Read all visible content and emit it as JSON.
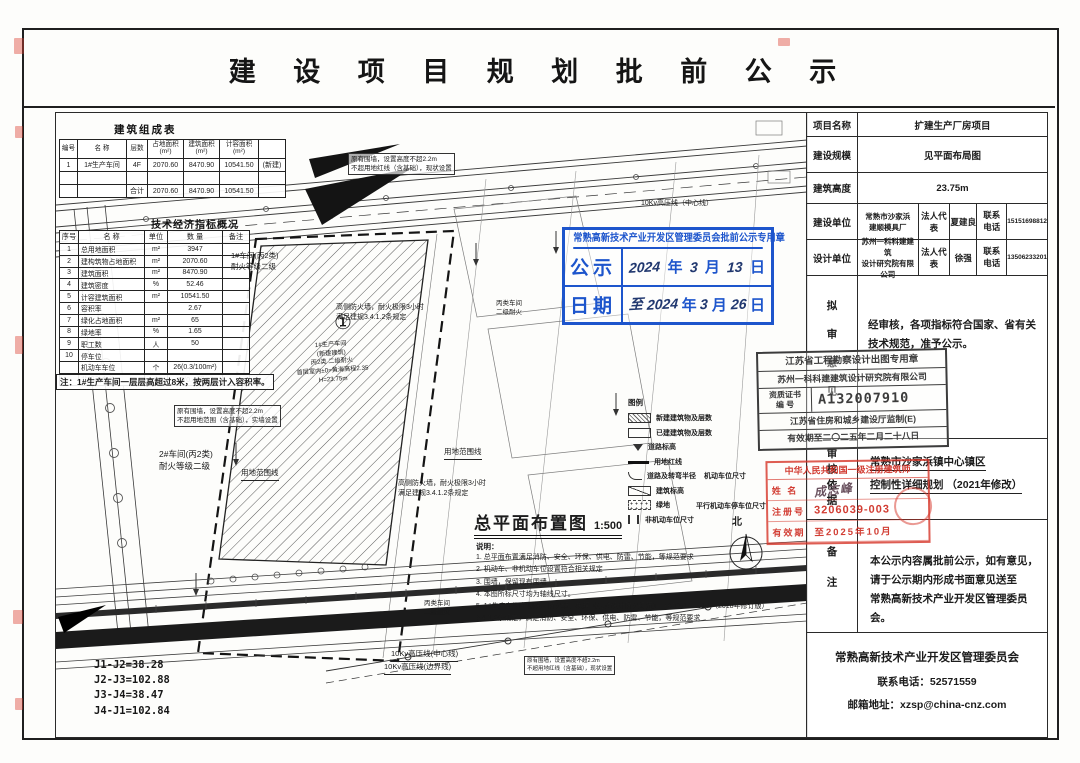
{
  "page": {
    "title": "建 设 项 目 规 划 批 前 公 示"
  },
  "comp_table": {
    "title": "建筑组成表",
    "h": [
      "编号",
      "名 称",
      "层数",
      "占地面积\n(m²)",
      "建筑面积\n(m²)",
      "计容面积\n(m²)",
      ""
    ],
    "rows": [
      [
        "1",
        "1#生产车间",
        "4F",
        "2070.60",
        "8470.90",
        "10541.50",
        "(新建)"
      ],
      [
        "",
        "",
        "",
        "",
        "",
        "",
        ""
      ],
      [
        "",
        "",
        "合计",
        "2070.60",
        "8470.90",
        "10541.50",
        ""
      ]
    ]
  },
  "ind_table": {
    "title": "技术经济指标概况",
    "h": [
      "序号",
      "名  称",
      "单位",
      "数 量",
      "备注"
    ],
    "rows": [
      [
        "1",
        "总用地面积",
        "m²",
        "3947",
        ""
      ],
      [
        "2",
        "建构筑物占地面积",
        "m²",
        "2070.60",
        ""
      ],
      [
        "3",
        "建筑面积",
        "m²",
        "8470.90",
        ""
      ],
      [
        "4",
        "建筑密度",
        "%",
        "52.46",
        ""
      ],
      [
        "5",
        "计容建筑面积",
        "m²",
        "10541.50",
        ""
      ],
      [
        "6",
        "容积率",
        "",
        "2.67",
        ""
      ],
      [
        "7",
        "绿化占地面积",
        "m²",
        "65",
        ""
      ],
      [
        "8",
        "绿地率",
        "%",
        "1.65",
        ""
      ],
      [
        "9",
        "职工数",
        "人",
        "50",
        ""
      ],
      [
        "10",
        "停车位",
        "",
        "",
        ""
      ],
      [
        "",
        "机动车车位",
        "个",
        "26(0.3/100m²)",
        ""
      ],
      [
        "",
        "非机动车位",
        "个",
        "20(0.4/职工)",
        ""
      ]
    ],
    "note": "注：1#生产车间一层层高超过8米，按两层计入容积率。"
  },
  "plan": {
    "title": "总平面布置图",
    "scale": "1:500",
    "notes_title": "说明：",
    "notes": [
      "1. 总平面布置满足消防、安全、环保、供电、防雷、节能，等规范要求",
      "2. 机动车、非机动车位设置符合相关规定",
      "3. 围墙，保留现有围墙",
      "4. 本图所标尺寸均为轴线尺寸。",
      "5. 1#生产车间东侧设置防火墙，按照《建筑设计防火规范》 GB50016-2014 （2018年修订版）",
      "3.4.1.2条规定，满足消防、安全、环保、供电、防雷、节能，等规范要求"
    ],
    "legend_title": "图例",
    "legend": [
      "新建建筑物及层数",
      "已建建筑物及层数",
      "道路标高",
      "用地红线",
      "道路及转弯半径",
      "建筑标高",
      "绿地",
      "非机动车位尺寸"
    ],
    "legend_extra1": "机动车位尺寸",
    "legend_extra2": "平行机动车停车位尺寸",
    "north": "北",
    "j_list": [
      "J1-J2=38.28",
      "J2-J3=102.88",
      "J3-J4=38.47",
      "J4-J1=102.84"
    ]
  },
  "ann": {
    "wall_note_top": "原有围墙，设置高度不超2.2m\n不超用地红线（含基础），现状设置",
    "hv_top": "10Kv高压线（中心线）",
    "w1": "1#车间(丙2类)\n耐火等级二级",
    "fw1": "高侧防火墙，耐火极限3小时\n满足建规3.4.1.2条规定",
    "bldg_no": "①",
    "bldg": "1#生产车间\n(新建建筑)\n丙2类 二级耐火\n首层室内±0=黄海高程2.35\nH=23.75m",
    "wall_note_left": "原有围墙，设置高度不超2.2m\n不超用地范围（含基础），实墙设置",
    "w2": "2#车间(丙2类)\n耐火等级二级",
    "redline1": "用地范围线",
    "redline2": "用地范围线",
    "fw2": "高侧防火墙，耐火极限3小时\n满足建规3.4.1.2条规定",
    "nb1": "丙类车间\n二级耐火",
    "nb2": "丙类车间\n二级耐火",
    "hv_center": "10Kv高压线(中心线)",
    "hv_edge": "10Kv高压线(边界线)",
    "wall_note_bottom": "原有围墙，设置高度不超2.2m\n不超用地红线（含基础），现状设置"
  },
  "blue_stamp": {
    "title": "常熟高新技术产业开发区管理委员会批前公示专用章",
    "row1_label": "公示",
    "row2_label": "日期",
    "r1_year": "2024",
    "r1_y": "年",
    "r1_month": "3",
    "r1_m": "月",
    "r1_day": "13",
    "r1_d": "日",
    "r2_zhi": "至",
    "r2_year": "2024",
    "r2_y": "年",
    "r2_month": "3",
    "r2_m": "月",
    "r2_day": "26",
    "r2_d": "日"
  },
  "design_stamp": {
    "line1": "江苏省工程勘察设计出图专用章",
    "line2": "苏州一科科建建筑设计研究院有限公司",
    "cert_label1": "资质证书",
    "cert_label2": "编    号",
    "cert_no": "A132007910",
    "line4": "江苏省住房和城乡建设厅监制(E)",
    "line5": "有效期至二〇二五年二月二十八日"
  },
  "arch_stamp": {
    "line1": "中华人民共和国一级注册建筑师",
    "name_label": "姓 名",
    "name": "成志峰",
    "no_label": "注册号",
    "no": "3206039-003",
    "valid_label": "有效期",
    "valid": "至2025年10月"
  },
  "panel": {
    "r1": {
      "label": "项目名称",
      "value": "扩建生产厂房项目"
    },
    "r2": {
      "label": "建设规模",
      "value": "见平面布局图"
    },
    "r3": {
      "label": "建筑高度",
      "value": "23.75m"
    },
    "r4": {
      "label": "建设单位",
      "company": "常熟市沙家浜\n建顺模具厂",
      "rep_label": "法人代表",
      "rep": "夏建良",
      "tel_label": "联系电话",
      "tel": "15151698812"
    },
    "r5": {
      "label": "设计单位",
      "company": "苏州一科科建建筑\n设计研究院有限公司",
      "rep_label": "法人代表",
      "rep": "徐强",
      "tel_label": "联系电话",
      "tel": "13506233201"
    },
    "r6": {
      "label": "拟审意见",
      "value": "经审核，各项指标符合国家、省有关\n技术规范，准予公示。"
    },
    "r7": {
      "label": "审核依据",
      "line1": "常熟市沙家浜镇中心镇区",
      "line2": "控制性详细规划 （2021年修改）"
    },
    "r8": {
      "label": "备注",
      "value": "本公示内容属批前公示，如有意见，\n请于公示期内形成书面意见送至\n常熟高新技术产业开发区管理委员会。"
    },
    "footer": {
      "org": "常熟高新技术产业开发区管理委员会",
      "tel_label": "联系电话：",
      "tel": "52571559",
      "mail_label": "邮箱地址：",
      "mail": "xzsp@china-cnz.com"
    }
  }
}
